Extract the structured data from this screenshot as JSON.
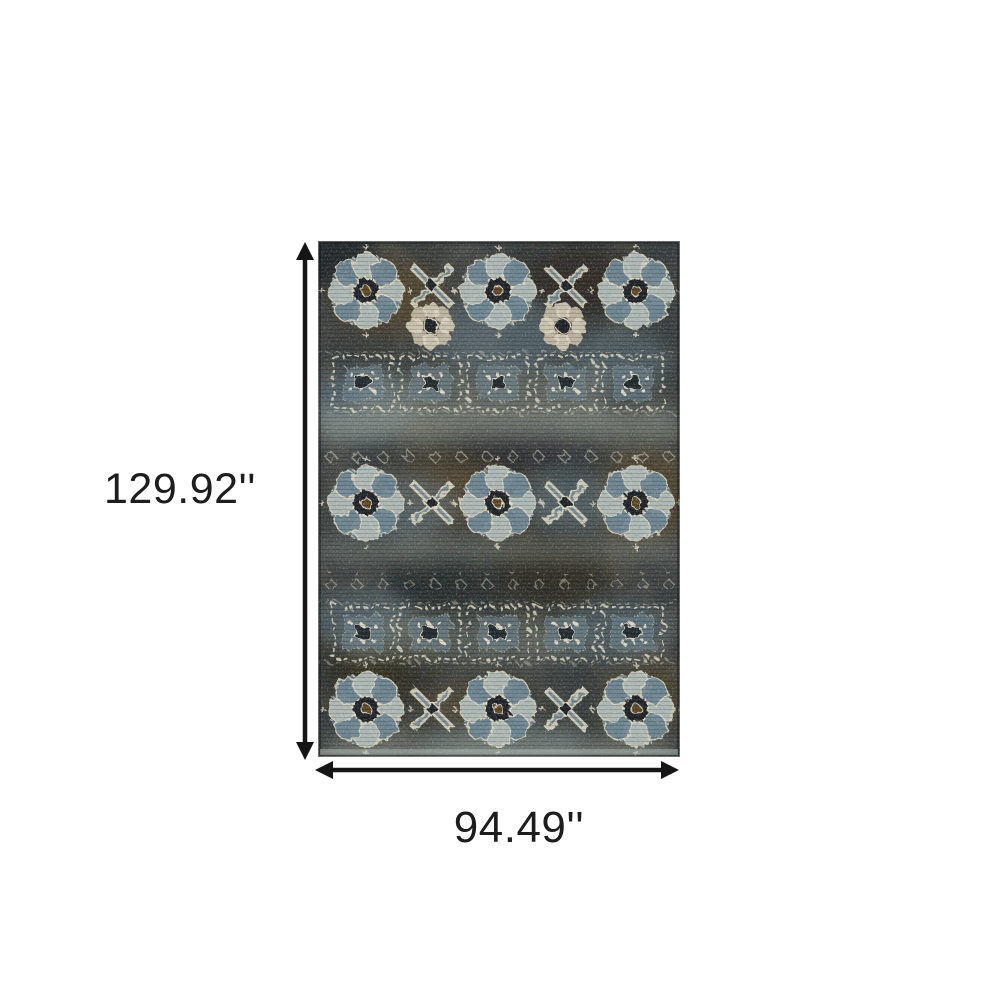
{
  "page": {
    "background": "#ffffff",
    "type_hint": "product dimension diagram"
  },
  "dimension_annotation": {
    "height_label": "129.92''",
    "width_label": "94.49''",
    "arrow_color": "#151515",
    "label_color": "#1d1d1d"
  },
  "rug": {
    "palette": {
      "base": "#3b4142",
      "charcoal": "#21262a",
      "slate": "#6e8693",
      "lightgray": "#b5bfba",
      "sage": "#99a193",
      "brown": "#5f482a",
      "darkbrown": "#2f2517",
      "cream": "#ddd7c3"
    }
  }
}
